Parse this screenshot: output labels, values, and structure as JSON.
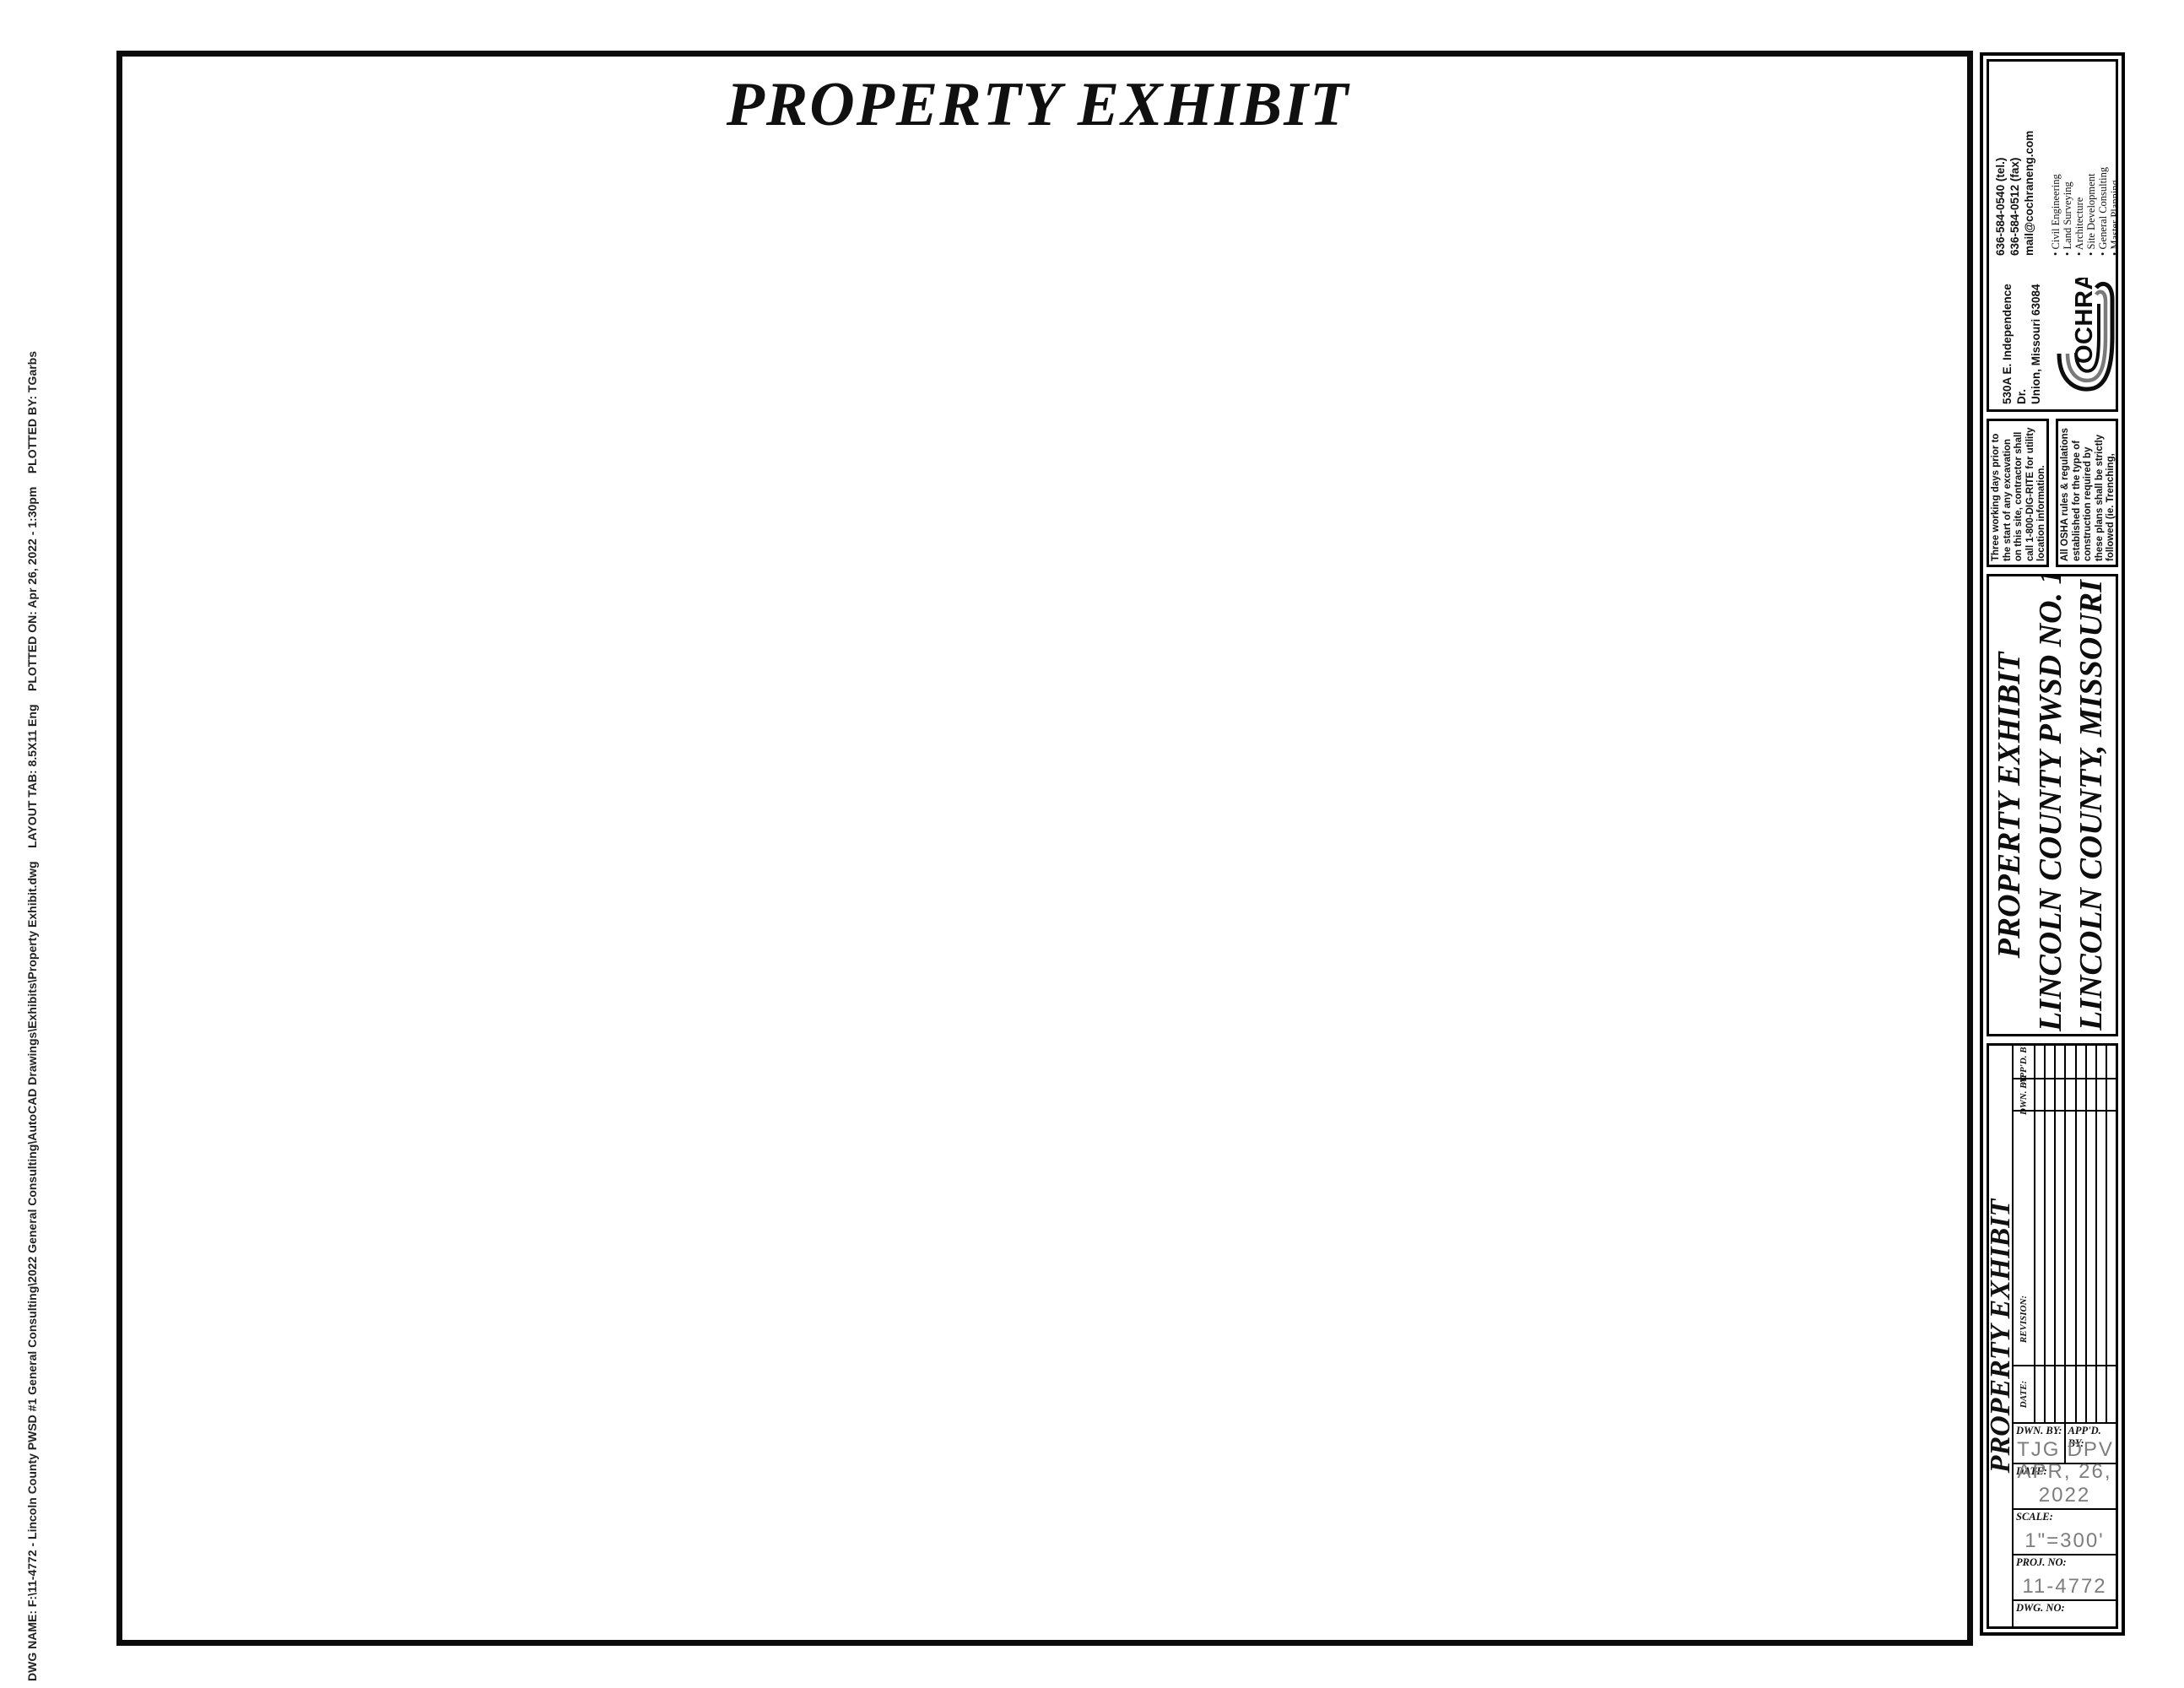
{
  "sheet": {
    "title": "PROPERTY EXHIBIT"
  },
  "plot_stamp": "DWG NAME: F:\\11-4772 - Lincoln County PWSD #1 General Consulting\\2022 General Consulting\\AutoCAD Drawings\\Exhibits\\Property Exhibit.dwg    LAYOUT TAB: 8.5X11 Eng    PLOTTED ON: Apr 26, 2022 - 1:30pm    PLOTTED BY: TGarbs",
  "north_scale": {
    "tick0": "0",
    "tick150": "150",
    "tick300": "300",
    "date": "APRIL, 2022"
  },
  "legend": {
    "title": "EXISTING WATER & SEWER LEGEND",
    "col_symbol": "SYMBOL",
    "col_designates": "DESIGNATES",
    "rows": [
      {
        "symbol": "4\"W",
        "designates": "4\" WATER MAIN",
        "color": "#1d4a1d"
      },
      {
        "symbol": "6\"W",
        "designates": "6\" WATER MAIN",
        "color": "#e01010"
      },
      {
        "symbol": "8\"W",
        "designates": "8\" WATER MAIN",
        "color": "#7a14e0"
      },
      {
        "symbol": "2\"FM",
        "designates": "2\" FORCE MAIN",
        "color": "#0d0d0d"
      },
      {
        "symbol": "3\"FM",
        "designates": "3\" FORCE MAIN",
        "color": "#e822e8"
      },
      {
        "symbol": "4\"FM",
        "designates": "4\" FORCE MAIN",
        "color": "#1fd4d4"
      },
      {
        "symbol": "6\"FM",
        "designates": "6\" FORCE MAIN",
        "color": "#1322cc"
      },
      {
        "symbol": "SAN",
        "designates": "8\" GRAVITY SEWER",
        "color": "#ef8d1a"
      }
    ]
  },
  "map": {
    "labels": {
      "w4": "4\"W",
      "w6": "6\"W",
      "w8": "8\"W",
      "fm2": "2\"FM",
      "fm3": "3\"FM",
      "fm4": "4\"FM",
      "fm6": "6\"FM",
      "san": "SAN",
      "rw": "R/W",
      "pl": "PL",
      "poi1": "PROPERTY",
      "poi2": "OF",
      "poi3": "INTEREST",
      "big_sanitary": "6\" Sanitary Force Main",
      "big_water": "6\" Water"
    }
  },
  "company": {
    "name_c": "C",
    "name_rest": "OCHRAN",
    "tel": "636-584-0540 (tel.)",
    "fax": "636-584-0512 (fax)",
    "email": "mail@cochraneng.com",
    "address1": "530A E. Independence Dr.",
    "address2": "Union, Missouri 63084",
    "services": [
      "Civil Engineering",
      "Land Surveying",
      "Architecture",
      "Site Development",
      "General Consulting",
      "Master Planning"
    ]
  },
  "notes": {
    "note1": "Three working days prior to the start of any excavation on this site, contractor shall call 1-800-DIG-RITE for utility location information.",
    "note2": "All OSHA rules & regulations established for the type of construction required by these plans shall be strictly followed (ie. Trenching, Blasting, etc.)"
  },
  "project": {
    "line1": "PROPERTY EXHIBIT",
    "line2": "LINCOLN COUNTY PWSD NO. 1",
    "line3": "LINCOLN COUNTY, MISSOURI"
  },
  "titleblock": {
    "side_label": "PROPERTY EXHIBIT",
    "rev_appd": "APP'D. BY:",
    "rev_dwn": "DWN. BY:",
    "rev_revision": "REVISION:",
    "rev_date": "DATE:",
    "dwn_label": "DWN. BY:",
    "dwn_value": "TJG",
    "appd_label": "APP'D. BY:",
    "appd_value": "DPV",
    "date_label": "DATE:",
    "date_value": "APR, 26, 2022",
    "scale_label": "SCALE:",
    "scale_value": "1\"=300'",
    "proj_label": "PROJ. NO:",
    "proj_value": "11-4772",
    "dwg_label": "DWG. NO:",
    "dwg_value": "EX. 1"
  }
}
